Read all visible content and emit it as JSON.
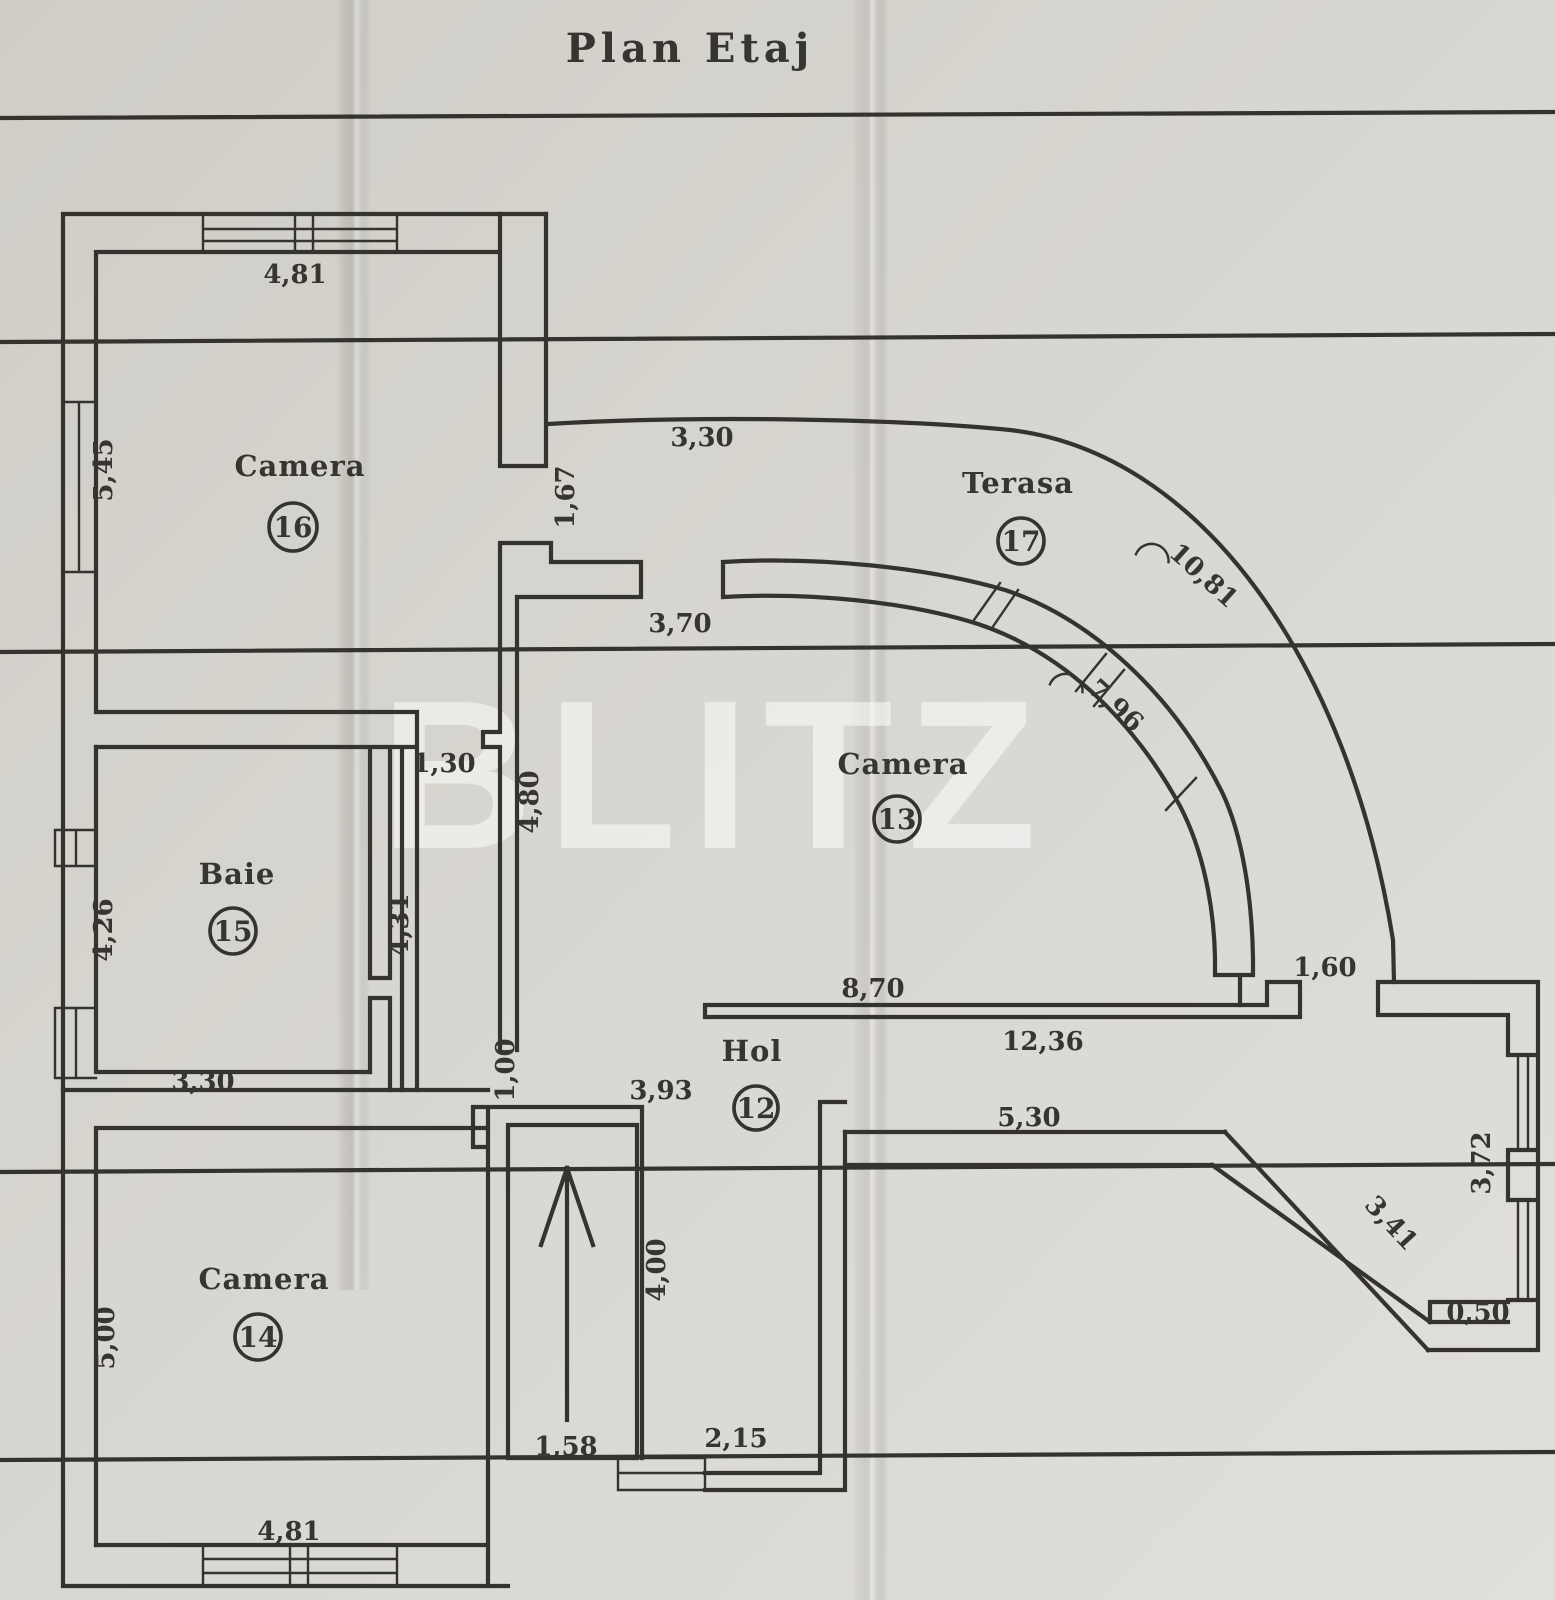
{
  "title": "Plan Etaj",
  "watermark": "BLITZ",
  "rooms": [
    {
      "name": "Camera",
      "number": "16"
    },
    {
      "name": "Baie",
      "number": "15"
    },
    {
      "name": "Camera",
      "number": "14"
    },
    {
      "name": "Camera",
      "number": "13"
    },
    {
      "name": "Terasa",
      "number": "17"
    },
    {
      "name": "Hol",
      "number": "12"
    }
  ],
  "dims": {
    "cam16_top": "4,81",
    "cam16_left": "5,45",
    "terasa_entry": "3,30",
    "door_cam16": "1,67",
    "cam13_entry": "3,70",
    "niche": "1,30",
    "corridor": "4,80",
    "baie_left": "4,26",
    "shaft": "4,31",
    "baie_bottom": "3,30",
    "hol_top": "8,70",
    "hol_length": "12,36",
    "terasa_door": "1,60",
    "passage": "1,00",
    "stair_top": "3,93",
    "hol_bottom": "5,30",
    "right_window": "3,72",
    "diagonal": "3,41",
    "corner": "0,50",
    "cam14_left": "5,00",
    "stair_length": "4,00",
    "stair_width": "1,58",
    "vestibule": "2,15",
    "terasa_arc_outer": "10,81",
    "terasa_arc_inner": "7,96"
  },
  "colors": {
    "paper": "#d7d5cf",
    "ink": "#35332d"
  }
}
